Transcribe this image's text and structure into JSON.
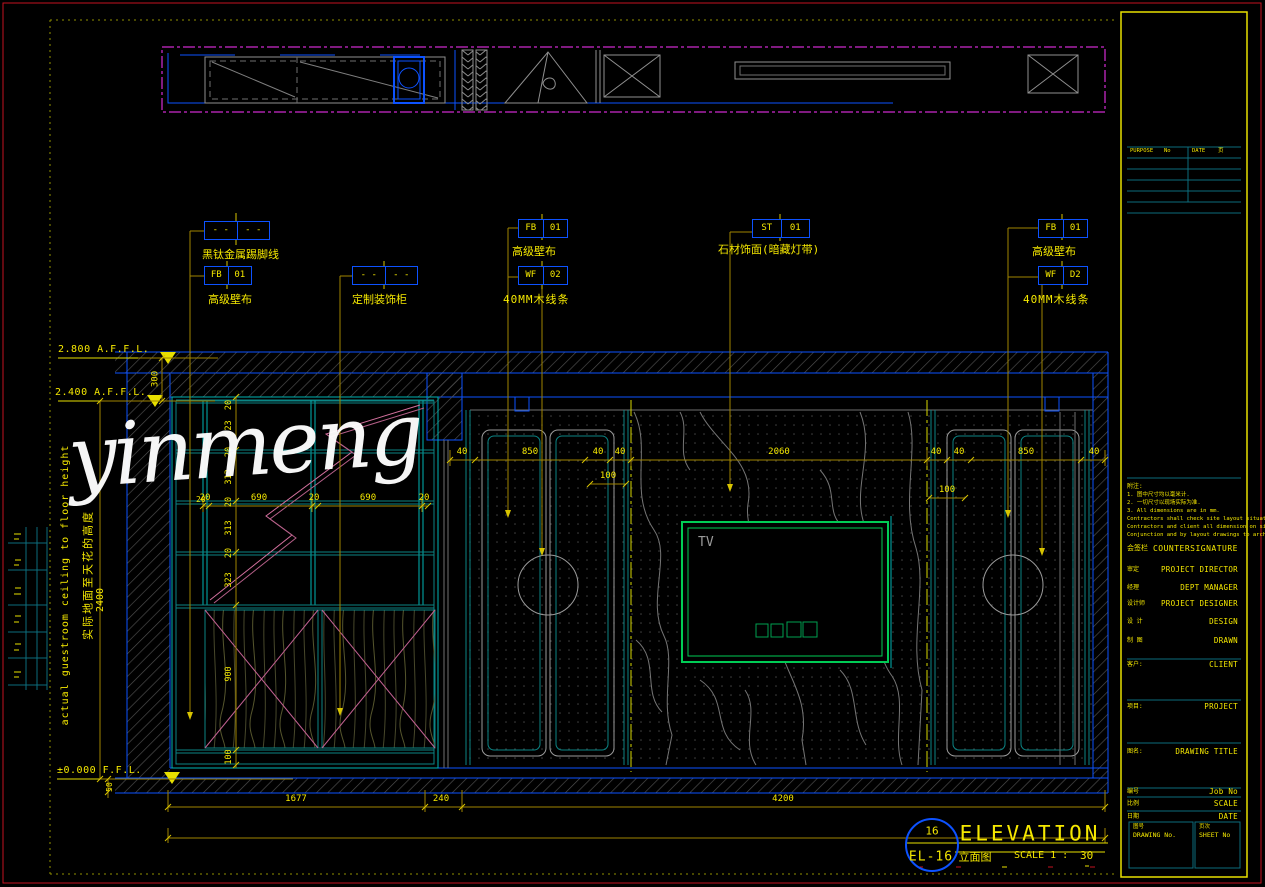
{
  "watermark": "yinmeng",
  "colors": {
    "cad_yellow": "#f5e800",
    "cad_blue": "#0d52ff",
    "cad_cyan": "#00b5b5",
    "cad_magenta": "#ff35ff",
    "tv_green": "#00cc55",
    "frame_red": "#c41220"
  },
  "levels": {
    "ceiling": "2.800 A.F.F.L.",
    "dropped": "2.400 A.F.F.L.",
    "floor": "±0.000 F.F.L."
  },
  "side": {
    "en": "actual guestroom ceiling to floor height",
    "cn": "实际地面至天花的高度",
    "room_h": "2400",
    "gap": "300",
    "base": "50"
  },
  "tags": {
    "skirting": {
      "l": "- -",
      "r": "- -",
      "label": "黑钛金属踢脚线"
    },
    "fb_left": {
      "l": "FB",
      "r": "01",
      "label": "高级壁布"
    },
    "cabinet": {
      "l": "- -",
      "r": "- -",
      "label": "定制装饰柜"
    },
    "fb_mid": {
      "l": "FB",
      "r": "01",
      "label": "高级壁布"
    },
    "wf_mid": {
      "l": "WF",
      "r": "02",
      "label": "40MM木线条"
    },
    "stone": {
      "l": "ST",
      "r": "01",
      "label": "石材饰面(暗藏灯带)"
    },
    "fb_right": {
      "l": "FB",
      "r": "01",
      "label": "高级壁布"
    },
    "wf_right": {
      "l": "WF",
      "r": "D2",
      "label": "40MM木线条"
    }
  },
  "dims": {
    "cab_top": [
      "20",
      "690",
      "20",
      "690",
      "20"
    ],
    "cab_side": [
      "20",
      "323",
      "20",
      "313",
      "20",
      "313",
      "20",
      "323",
      "900",
      "100"
    ],
    "side_20": "20",
    "panel": [
      "40",
      "850",
      "40",
      "40",
      "2060",
      "40",
      "40",
      "850",
      "40"
    ],
    "inset_left": "100",
    "inset_right": "100",
    "bottom": [
      "1677",
      "240",
      "4200"
    ]
  },
  "tv": "TV",
  "titlebar": {
    "num": "16",
    "code": "EL-16",
    "cn": "立面图",
    "name": "ELEVATION",
    "scale_label": "SCALE 1 :",
    "scale_value": "30"
  },
  "tb": {
    "rev": {
      "purpose": "PURPOSE",
      "no": "No",
      "date": "DATE",
      "page": "页"
    },
    "notes": [
      "附注:",
      "1. 图中尺寸均以毫米计.",
      "2. 一切尺寸以现场实际为准.",
      "3. All dimensions are in mm.",
      "Contractors shall check site layout situations and",
      "Contractors and client all dimension on site.",
      "Conjunction and by layout drawings to architects."
    ],
    "countersign_cn": "会签栏",
    "countersign_en": "COUNTERSIGNATURE",
    "rows": [
      {
        "cn": "审定",
        "en": "PROJECT DIRECTOR"
      },
      {
        "cn": "经理",
        "en": "DEPT MANAGER"
      },
      {
        "cn": "设计师",
        "en": "PROJECT DESIGNER"
      },
      {
        "cn": "设 计",
        "en": "DESIGN"
      },
      {
        "cn": "制 图",
        "en": "DRAWN"
      },
      {
        "cn": "客户:",
        "en": "CLIENT"
      },
      {
        "cn": "项目:",
        "en": "PROJECT"
      },
      {
        "cn": "图名:",
        "en": "DRAWING TITLE"
      },
      {
        "cn": "编号",
        "en": "Job No"
      },
      {
        "cn": "比例",
        "en": "SCALE"
      },
      {
        "cn": "日期",
        "en": "DATE"
      }
    ],
    "dno_cn": "图号",
    "dno_en": "DRAWING No.",
    "sno_cn": "页次",
    "sno_en": "SHEET No"
  }
}
